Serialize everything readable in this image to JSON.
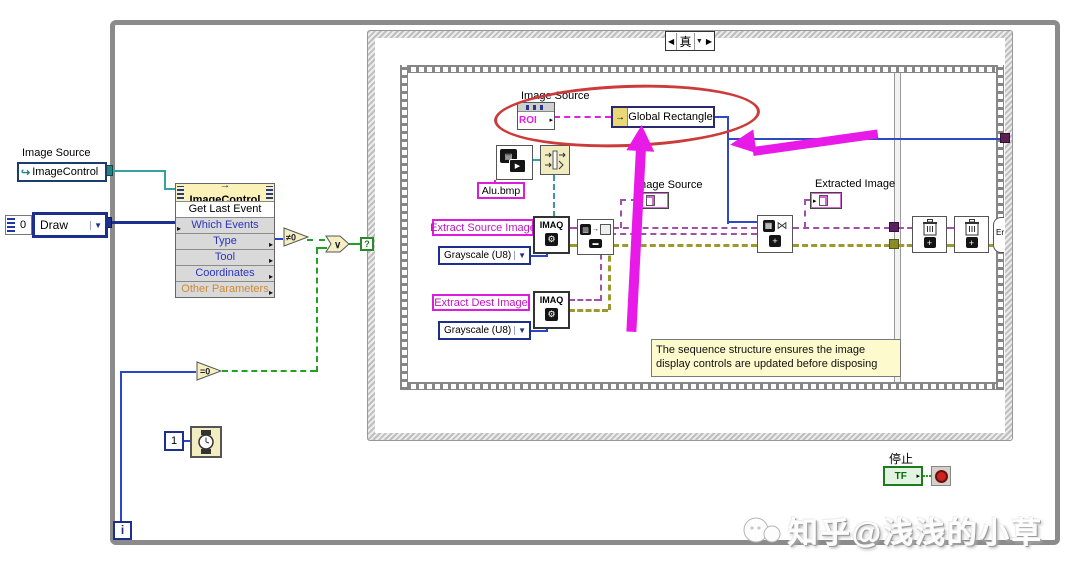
{
  "structures": {
    "case_selector": "真",
    "loop_iterator": "i",
    "selector_terminal": "?"
  },
  "controls": {
    "image_source_label": "Image Source",
    "image_control_ref": "ImageControl",
    "zero_const": "0",
    "draw_ring": "Draw",
    "one_const": "1",
    "stop_label": "停止",
    "stop_terminal": "TF"
  },
  "invoke_node": {
    "header": "ImageControl",
    "method": "Get Last Event",
    "param1": "Which Events",
    "param2": "Type",
    "param3": "Tool",
    "param4": "Coordinates",
    "param5": "Other Parameters"
  },
  "functions": {
    "neq_zero": "≠0",
    "eq_zero": "=0",
    "or": "∨",
    "imaq_create": "IMAQ",
    "error_node": "Er"
  },
  "frame1": {
    "property_node_label": "Image Source",
    "property_name": "ROI",
    "unbundle_field": "Global Rectangle",
    "file_name": "Alu.bmp",
    "extract_source_label": "Extract Source Image",
    "extract_dest_label": "Extract Dest Image",
    "grayscale_ring": "Grayscale (U8)",
    "image_source_indicator": "Image Source",
    "extracted_image_indicator": "Extracted Image",
    "comment": "The sequence structure ensures the image display controls are updated before disposing"
  },
  "icons": {
    "ref_arrow": "↪",
    "dropdown": "▼",
    "case_prev": "◀",
    "case_next": "▶",
    "arrow_right": "▸",
    "method_arrow": "→",
    "unbundle_arrow": "→",
    "gear": "⚙",
    "bowtie": "⋈",
    "image_chip": "▦",
    "plus": "+"
  },
  "colors": {
    "boolean_wire": "#22a022",
    "image_wire": "#a050a8",
    "error_wire": "#9a9a2e",
    "roi_wire": "#e020e0",
    "reference_wire": "#38a0a0",
    "integer_wire": "#2a46c8",
    "annotation_arrow": "#e81ae8",
    "annotation_circle": "#cc3a3a",
    "stop_button": "#cc2222"
  },
  "watermark": {
    "text": "知乎@浅浅的小草"
  }
}
